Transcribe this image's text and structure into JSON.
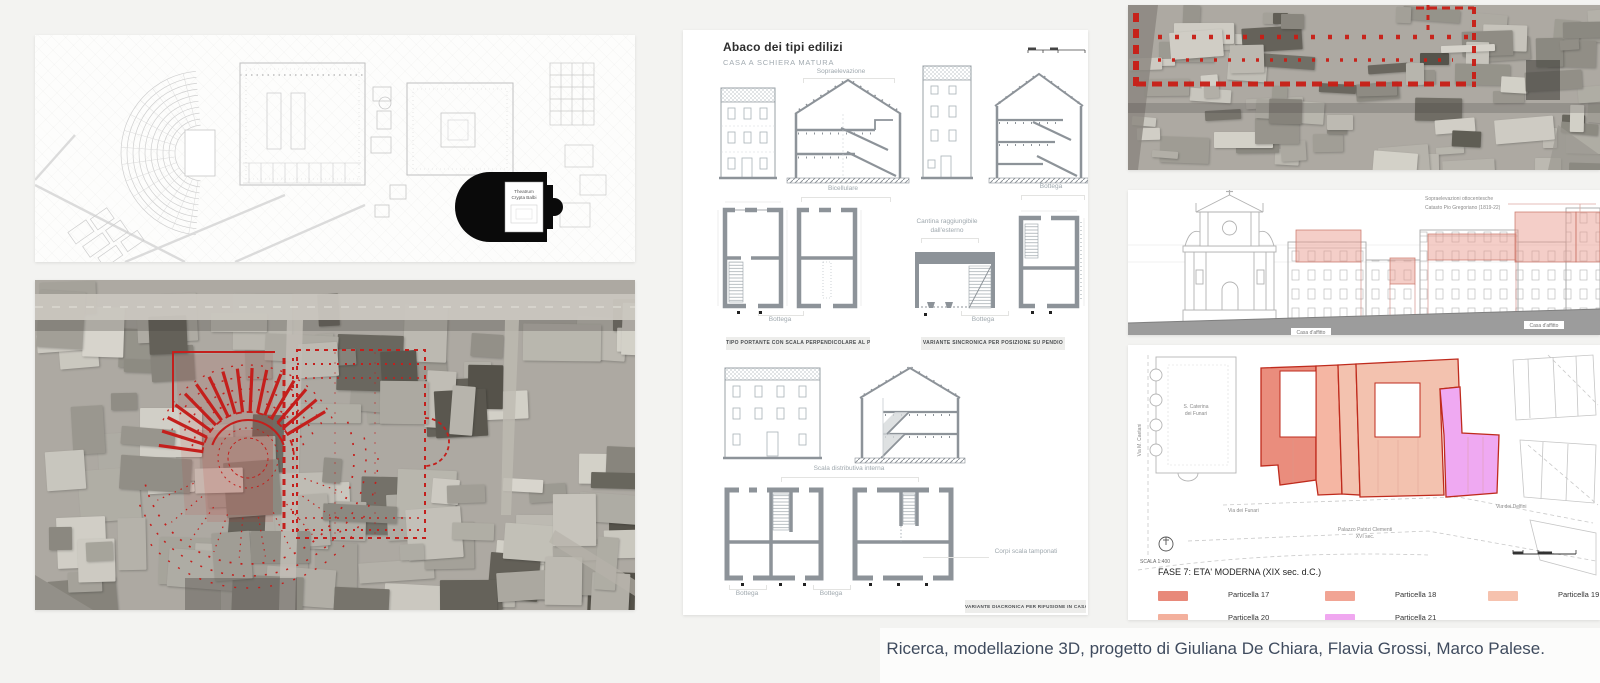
{
  "caption": "Ricerca, modellazione 3D, progetto di Giuliana De Chiara, Flavia Grossi, Marco Palese.",
  "map": {
    "theatre_line1": "Theatrum",
    "theatre_line2": "Crypta Balbi"
  },
  "abaco": {
    "title": "Abaco dei tipi edilizi",
    "subtitle": "CASA A SCHIERA MATURA",
    "labels": {
      "sopraelevazione": "Sopraelevazione",
      "bicellulare": "Bicellulare",
      "bottega_a": "Bottega",
      "cantina_1": "Cantina raggiungibile",
      "cantina_2": "dall'esterno",
      "bottega_b": "Bottega",
      "bottega_c": "Bottega",
      "scala_distributiva": "Scala distributiva interna",
      "bottega_d": "Bottega",
      "bottega_e": "Bottega",
      "corpi_scala": "Corpi scala tamponati"
    },
    "boxes": {
      "box1": "TIPO PORTANTE CON SCALA PERPENDICOLARE AL PERCORSO",
      "box2": "VARIANTE SINCRONICA PER POSIZIONE SU PENDIO",
      "box3": "VARIANTE DIACRONICA PER RIFUSIONE IN CASA IN LINEA"
    }
  },
  "elevation": {
    "note_line1": "Sopraelevazioni ottocentesche",
    "note_line2": "Catasto Pio Gregoriano (1819-22)",
    "label_left": "Casa d'affitto",
    "label_right": "Casa d'affitto"
  },
  "phase": {
    "church_1": "S. Caterina",
    "church_2": "dei Funari",
    "via_caetani": "Via M. Caetani",
    "via_funari": "Via dei Funari",
    "via_delfini": "Via dei Delfini",
    "palazzo_1": "Palazzo Patrizi Clementi",
    "palazzo_2": "XVI sec.",
    "scala": "SCALA 1:400",
    "title": "FASE 7: ETA' MODERNA (XIX sec. d.C.)",
    "legend": [
      {
        "label": "Particella 17",
        "color": "#e8897a"
      },
      {
        "label": "Particella 18",
        "color": "#f1a494"
      },
      {
        "label": "Particella 19",
        "color": "#f6c2ae"
      },
      {
        "label": "Particella 20",
        "color": "#f3b09d"
      },
      {
        "label": "Particella 21",
        "color": "#f0a7f0"
      }
    ]
  }
}
